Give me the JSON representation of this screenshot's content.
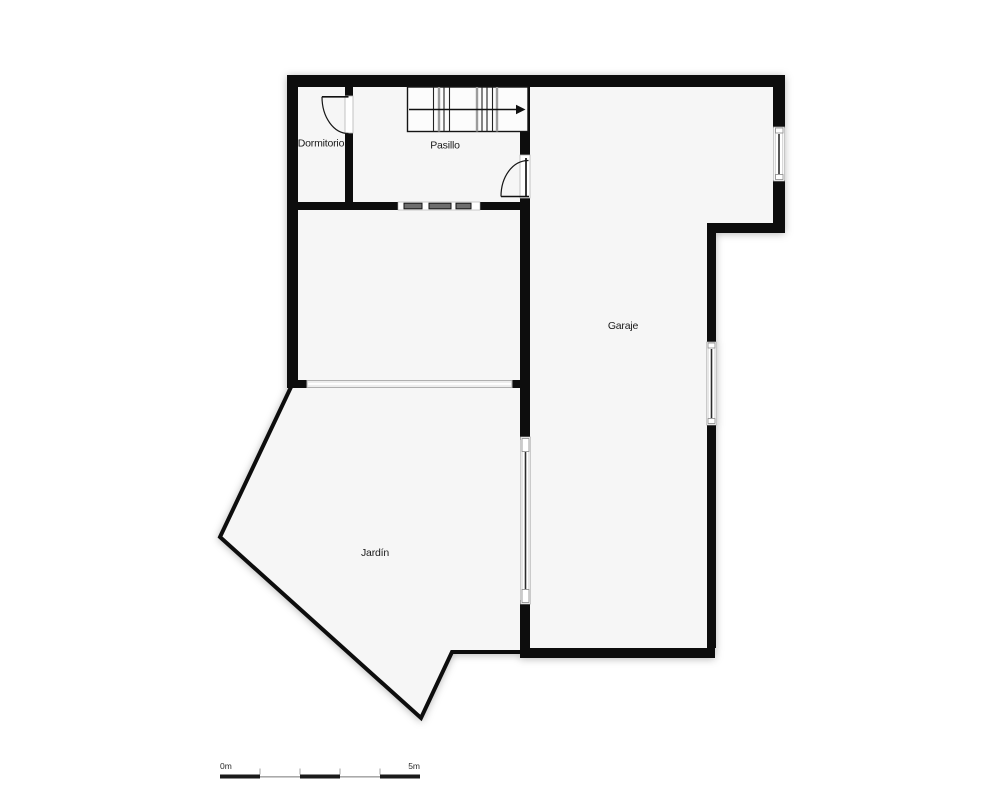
{
  "floor_plan": {
    "rooms": [
      {
        "name": "dormitorio",
        "label": "Dormitorio"
      },
      {
        "name": "pasillo",
        "label": "Pasillo"
      },
      {
        "name": "garaje",
        "label": "Garaje"
      },
      {
        "name": "jardin",
        "label": "Jardín"
      }
    ],
    "stairs": {
      "direction_icon": "arrow-right"
    },
    "scale_bar": {
      "start_label": "0m",
      "end_label": "5m"
    },
    "colors": {
      "wall": "#0d0d0d",
      "room_fill": "#f6f6f6",
      "background": "#ffffff",
      "window_glass": "#2e2e2e",
      "window_frame": "#b0b0b0",
      "label_text": "#1a1a1a"
    }
  }
}
